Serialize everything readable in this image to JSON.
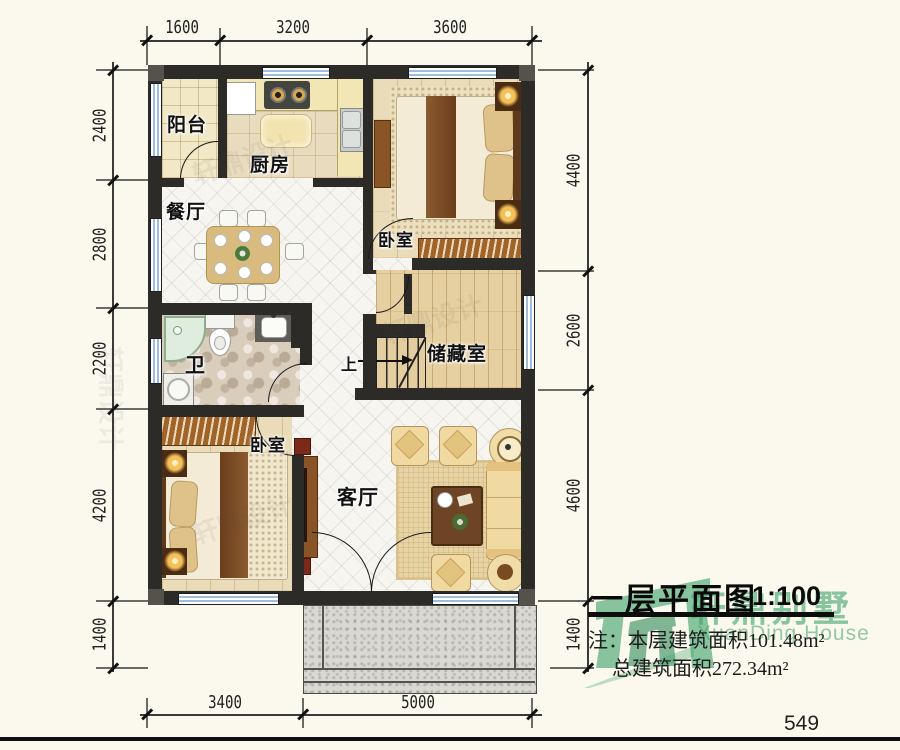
{
  "page": {
    "number": "549"
  },
  "title": {
    "text": "一层平面图",
    "scale": "1:100"
  },
  "notes": {
    "line1": "注：本层建筑面积101.48m²",
    "line2": "总建筑面积272.34m²"
  },
  "logo": {
    "cn": "轩鼎别墅",
    "en": "XuanDing House",
    "color": "#3BA169"
  },
  "watermark": {
    "text": "轩鼎设计"
  },
  "rooms": {
    "balcony": {
      "label": "阳台"
    },
    "kitchen": {
      "label": "厨房"
    },
    "dining": {
      "label": "餐厅"
    },
    "bedroom_top": {
      "label": "卧室"
    },
    "bathroom": {
      "label": "卫"
    },
    "storage": {
      "label": "储藏室"
    },
    "living": {
      "label": "客厅"
    },
    "bedroom_bottom": {
      "label": "卧室"
    },
    "stairs": {
      "label": "上"
    }
  },
  "dimensions": {
    "top": [
      "1600",
      "3200",
      "3600"
    ],
    "left": [
      "2400",
      "2800",
      "2200",
      "4200",
      "1400"
    ],
    "right": [
      "4400",
      "2600",
      "4600",
      "1400"
    ],
    "bottom": [
      "3400",
      "5000"
    ]
  }
}
